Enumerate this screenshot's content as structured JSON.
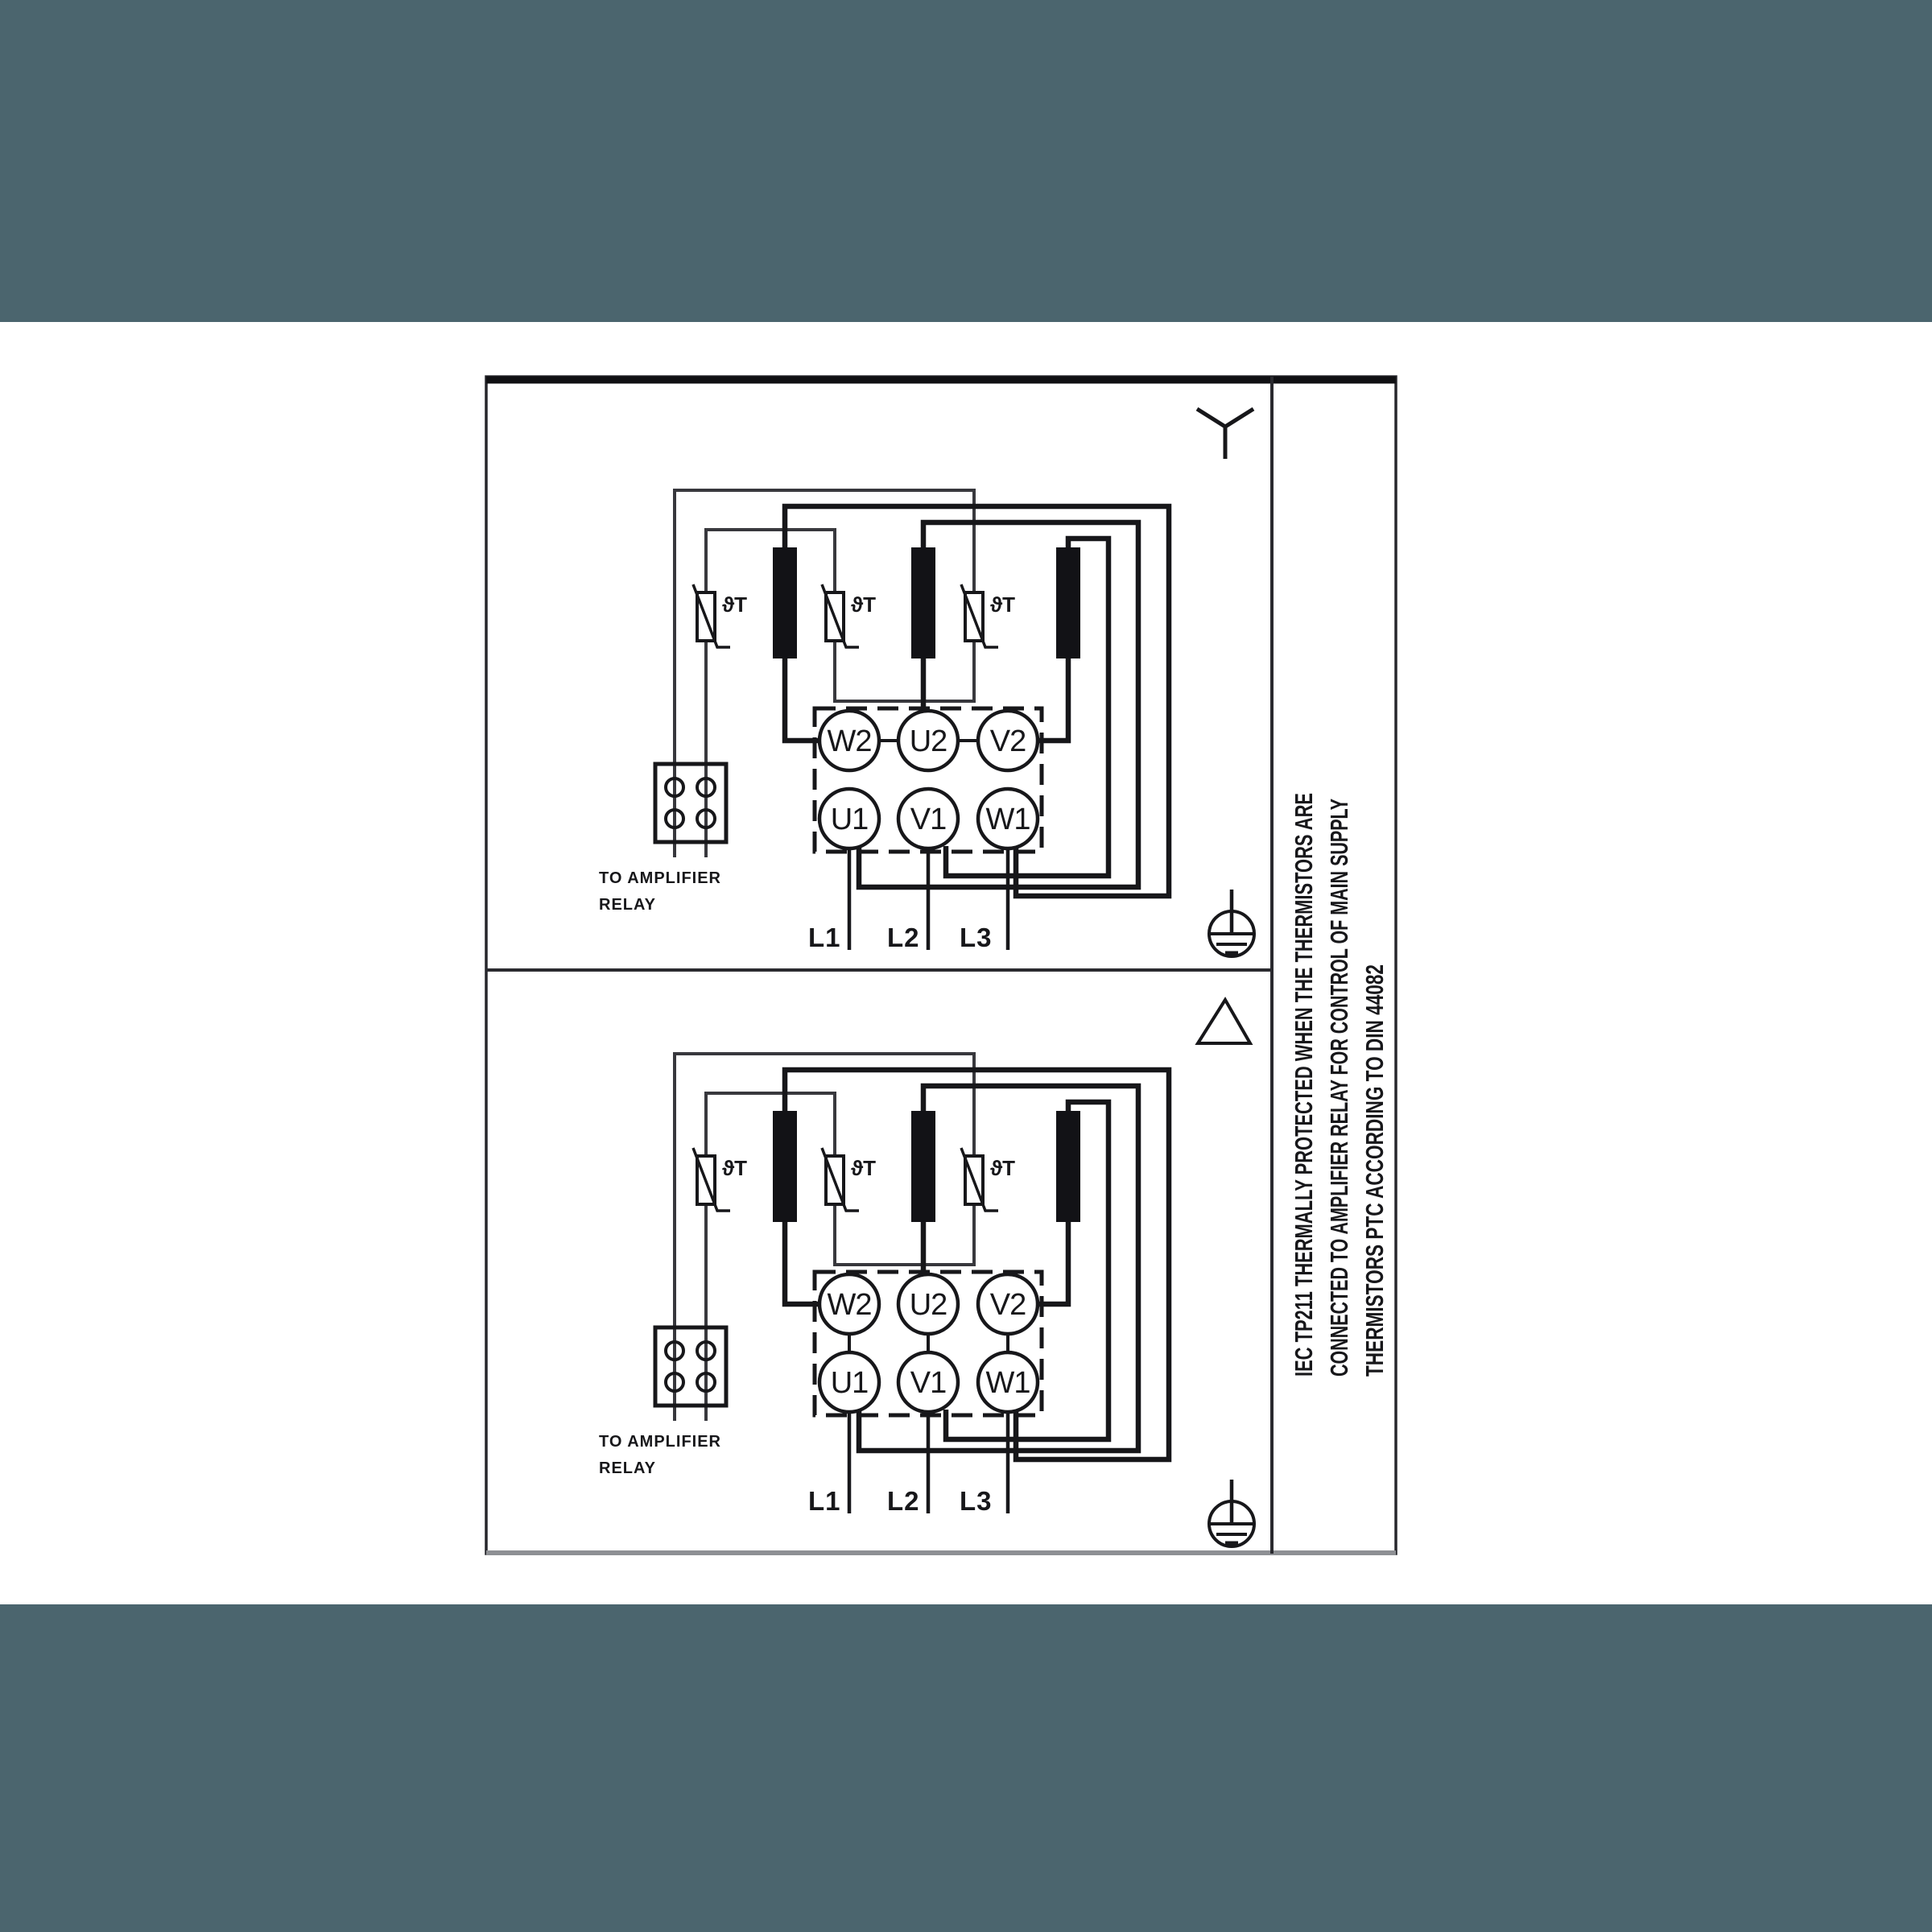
{
  "page": {
    "band_color": "#4b656e",
    "paper_color": "#ffffff",
    "ink_color": "#17171a"
  },
  "note_lines": [
    "IEC TP211 THERMALLY PROTECTED WHEN THE THERMISTORS ARE",
    "CONNECTED TO AMPLIFIER RELAY FOR CONTROL OF MAIN SUPPLY",
    "THERMISTORS PTC ACCORDING TO DIN 44082"
  ],
  "panels": [
    {
      "id": "star",
      "connection_symbol": "star",
      "terminals_top": [
        "W2",
        "U2",
        "V2"
      ],
      "terminals_bottom": [
        "U1",
        "V1",
        "W1"
      ],
      "supply": [
        "L1",
        "L2",
        "L3"
      ],
      "relay_line1": "TO AMPLIFIER",
      "relay_line2": "RELAY",
      "thermistor_label": "ϑT"
    },
    {
      "id": "delta",
      "connection_symbol": "delta",
      "terminals_top": [
        "W2",
        "U2",
        "V2"
      ],
      "terminals_bottom": [
        "U1",
        "V1",
        "W1"
      ],
      "supply": [
        "L1",
        "L2",
        "L3"
      ],
      "relay_line1": "TO AMPLIFIER",
      "relay_line2": "RELAY",
      "thermistor_label": "ϑT"
    }
  ]
}
